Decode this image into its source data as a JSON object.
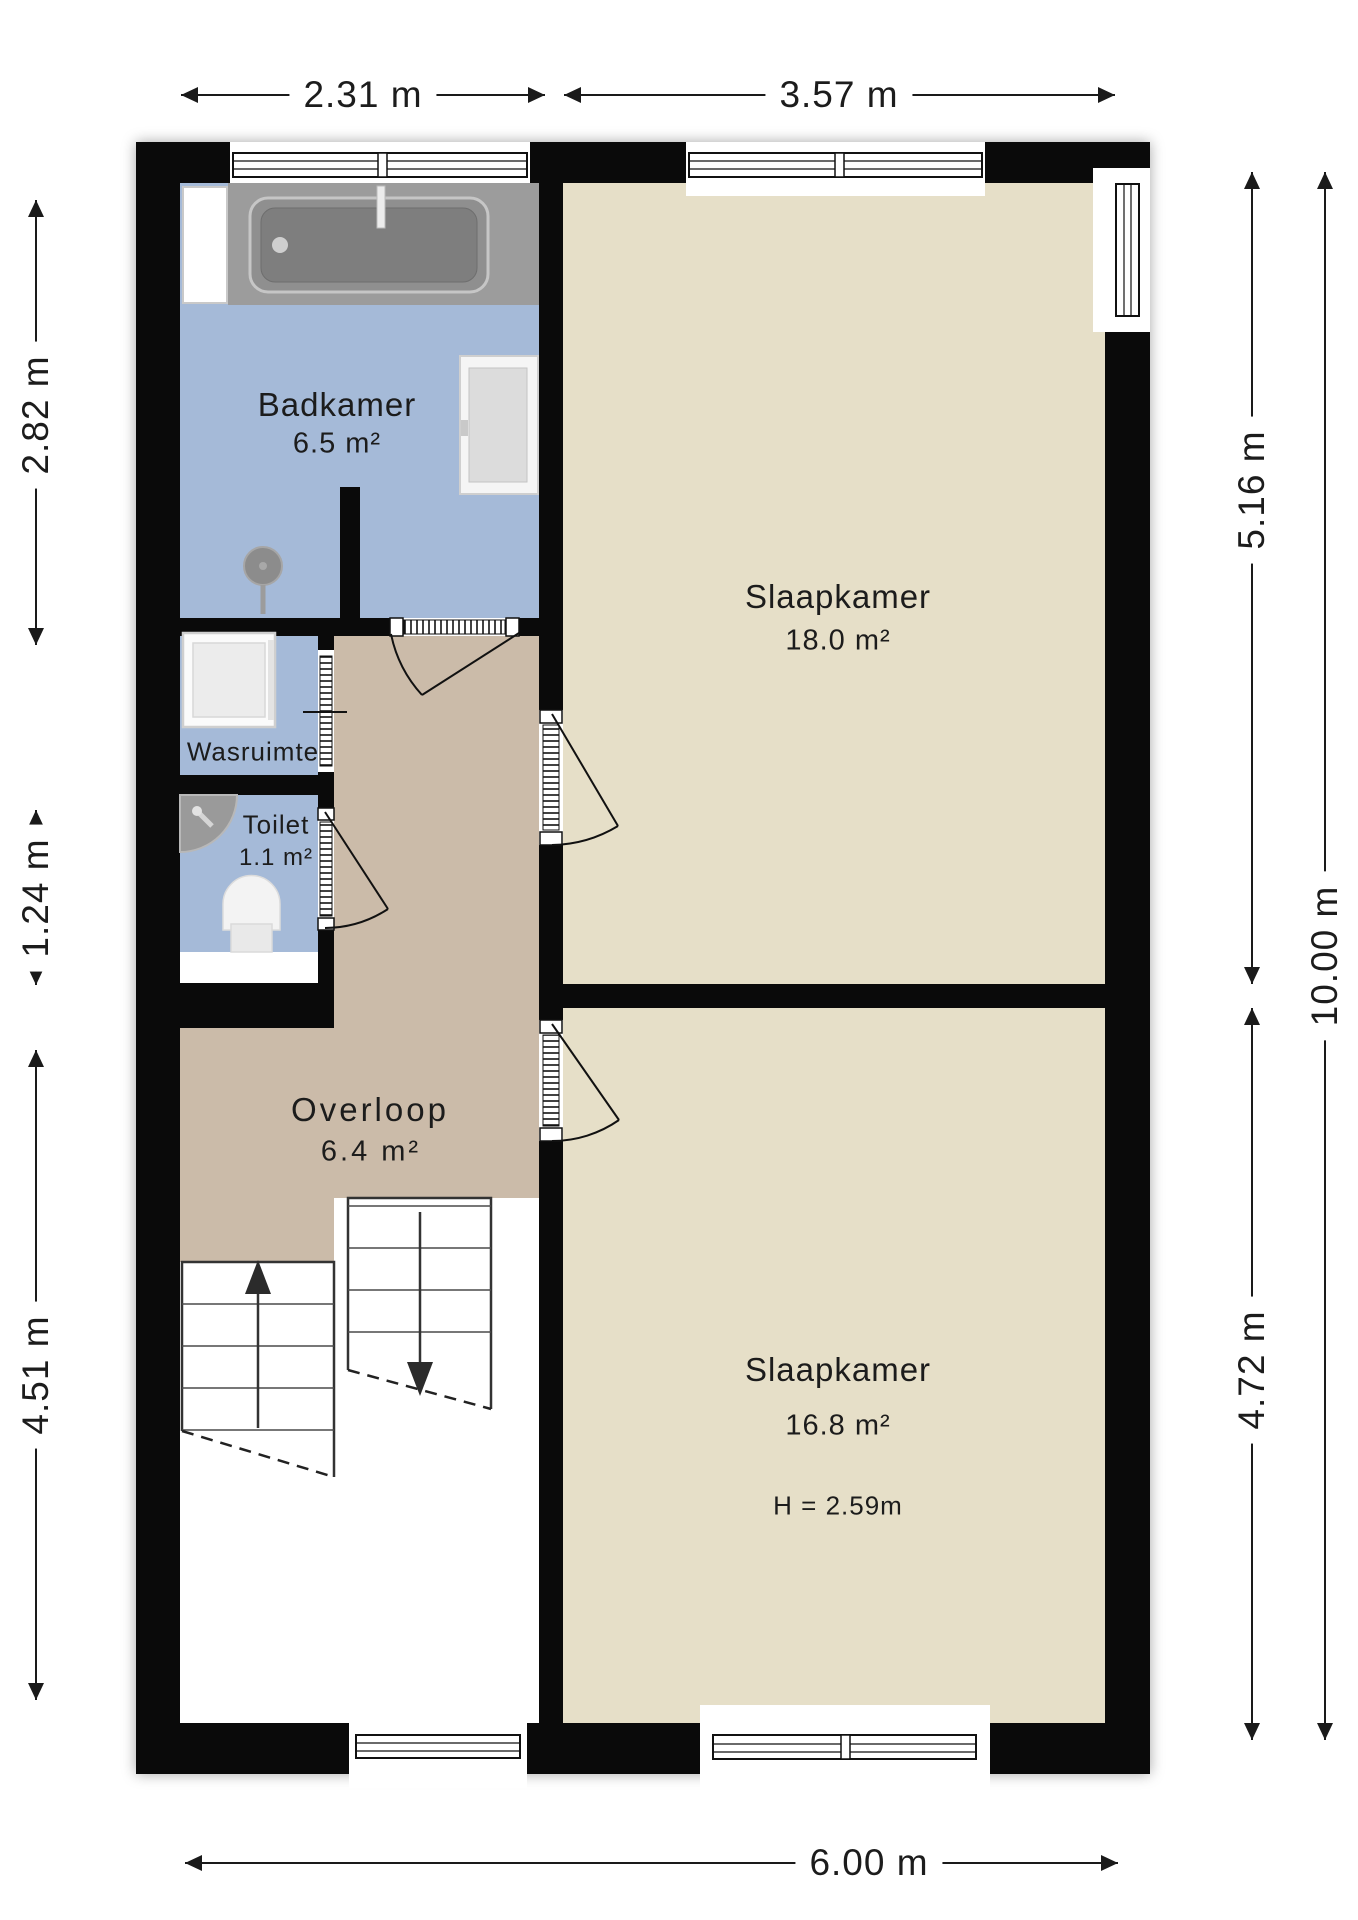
{
  "plan": {
    "title": "first-floor-plan",
    "rooms": {
      "badkamer": {
        "name": "Badkamer",
        "area": "6.5 m²"
      },
      "wasruimte": {
        "name": "Wasruimte"
      },
      "toilet": {
        "name": "Toilet",
        "area": "1.1 m²"
      },
      "overloop": {
        "name": "Overloop",
        "area": "6.4 m²"
      },
      "slaapkamer_boven": {
        "name": "Slaapkamer",
        "area": "18.0 m²"
      },
      "slaapkamer_onder": {
        "name": "Slaapkamer",
        "area": "16.8 m²",
        "ceiling_height": "H = 2.59m"
      }
    },
    "dimensions": {
      "top_left": "2.31 m",
      "top_right": "3.57 m",
      "left_upper": "2.82 m",
      "left_middle": "1.24 m",
      "left_lower": "4.51 m",
      "right_upper": "5.16 m",
      "right_lower": "4.72 m",
      "right_total": "10.00 m",
      "bottom": "6.00 m"
    },
    "fixtures": [
      "bathtub",
      "shower-head",
      "mirror-cabinet",
      "washing-machine",
      "corner-sink",
      "toilet-bowl",
      "staircase-up",
      "staircase-down"
    ],
    "colors": {
      "wet_room_floor": "#a5bad8",
      "bedroom_floor": "#e6dfc8",
      "hallway_floor": "#cbbba9",
      "wall": "#0a0a0a",
      "fixture_gray": "#9c9c9c"
    }
  }
}
